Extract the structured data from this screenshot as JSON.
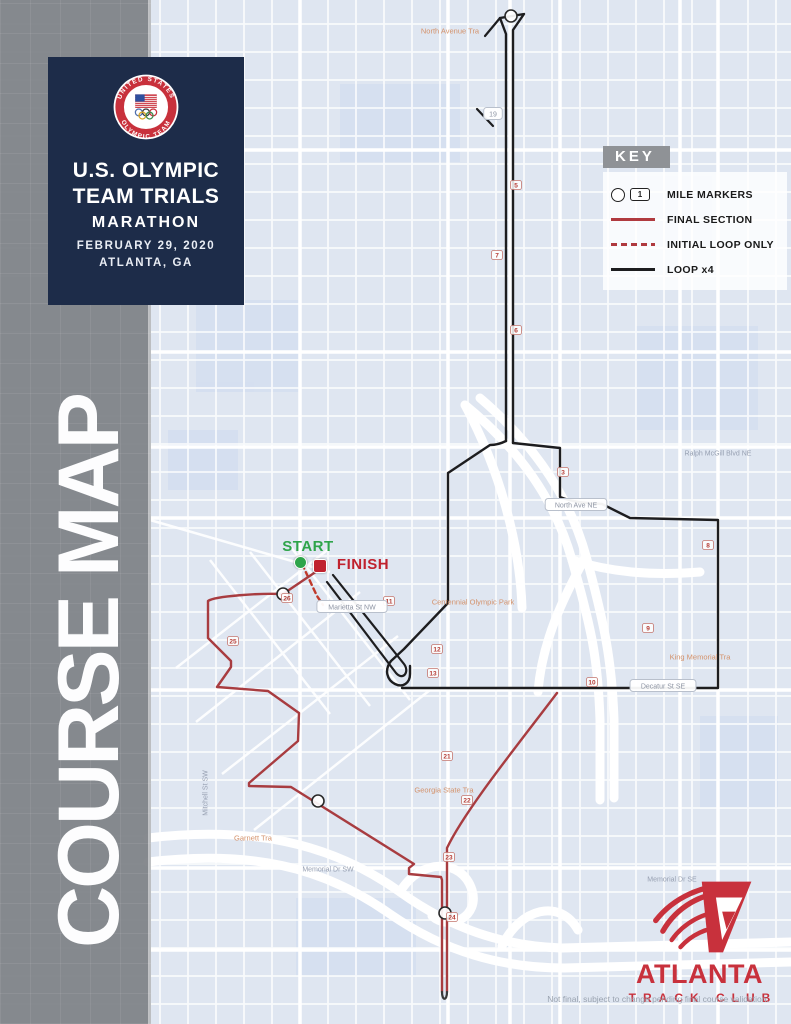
{
  "sidebar": {
    "vertical_text": "COURSE MAP"
  },
  "title_card": {
    "line1": "U.S. OLYMPIC",
    "line2": "TEAM TRIALS",
    "line3": "MARATHON",
    "line4": "FEBRUARY 29, 2020",
    "line5": "ATLANTA, GA",
    "logo_ring_top": "UNITED STATES",
    "logo_ring_bottom": "OLYMPIC TEAM"
  },
  "key": {
    "title": "KEY",
    "mile_marker_sample_number": "1",
    "items": [
      {
        "label": "MILE MARKERS"
      },
      {
        "label": "FINAL SECTION"
      },
      {
        "label": "INITIAL LOOP ONLY"
      },
      {
        "label": "LOOP x4"
      }
    ]
  },
  "start_finish": {
    "start": "START",
    "finish": "FINISH"
  },
  "atc_logo": {
    "name": "ATLANTA",
    "sub": "TRACK CLUB"
  },
  "footer": {
    "disclaimer": "Not final, subject to change pending final course validation."
  },
  "colors": {
    "navy": "#1d2c49",
    "sidebar_gray": "#8b8e93",
    "accent_red": "#c8313c",
    "route_red": "#a83c40",
    "route_black": "#1d1d1f",
    "start_green": "#2ea44a"
  },
  "map": {
    "routes": [
      {
        "name": "loop-north-outback",
        "color": "#1d1d1f",
        "width": 2.4,
        "d": "M 506,441 L 506,34 L 500,18 L 524,14 L 513,30 L 513,443"
      },
      {
        "name": "loop-north-hook-a",
        "color": "#1d1d1f",
        "width": 2.2,
        "d": "M 500,18 L 485,36"
      },
      {
        "name": "loop-north-hook-b",
        "color": "#1d1d1f",
        "width": 2.2,
        "d": "M 477,109 L 493,126"
      },
      {
        "name": "loop-west-side",
        "color": "#1d1d1f",
        "width": 2.4,
        "d": "M 506,441 C 500,444 495,445 490,445 L 448,473 L 448,603 L 404,649 L 391,661 C 384,670 387,680 395,684 C 403,688 410,683 410,674 L 410,666"
      },
      {
        "name": "loop-east-side",
        "color": "#1d1d1f",
        "width": 2.4,
        "d": "M 513,443 L 560,448 L 560,497 C 572,502 585,503 602,504 L 630,518 L 718,520 L 718,688 L 402,688"
      },
      {
        "name": "loop-downtown-spur",
        "color": "#1d1d1f",
        "width": 2.2,
        "d": "M 333,575 L 404,664 C 410,672 403,681 396,673 L 327,582"
      },
      {
        "name": "initial-loop-only",
        "color": "#c0392b",
        "width": 2.4,
        "dash": "5,4",
        "d": "M 302,564 L 317,596 L 323,605"
      },
      {
        "name": "final-section-west",
        "color": "#a83c40",
        "width": 2.4,
        "d": "M 320,569 L 283,594 C 260,593 215,596 208,601 L 208,638 L 231,661 L 231,667 L 217,687 L 268,691 L 299,713 L 298,741 L 249,783 L 249,786 L 291,787 L 414,864 L 409,868 L 409,874 L 441,877 L 442,880 L 442,992"
      },
      {
        "name": "final-section-east",
        "color": "#a83c40",
        "width": 2.4,
        "d": "M 447,992 L 447,848 C 465,810 520,742 557,693"
      },
      {
        "name": "final-turnaround",
        "color": "#3a3a3a",
        "width": 2.2,
        "d": "M 442,992 C 442,1001 447,1001 447,992"
      }
    ],
    "circles": [
      {
        "x": 283,
        "y": 594
      },
      {
        "x": 318,
        "y": 801
      },
      {
        "x": 445,
        "y": 913
      },
      {
        "x": 511,
        "y": 16
      }
    ],
    "mile_squares": [
      {
        "x": 516,
        "y": 185,
        "n": "5"
      },
      {
        "x": 516,
        "y": 330,
        "n": "6"
      },
      {
        "x": 497,
        "y": 255,
        "n": "7"
      },
      {
        "x": 563,
        "y": 472,
        "n": "3"
      },
      {
        "x": 708,
        "y": 545,
        "n": "8"
      },
      {
        "x": 648,
        "y": 628,
        "n": "9"
      },
      {
        "x": 592,
        "y": 682,
        "n": "10"
      },
      {
        "x": 389,
        "y": 601,
        "n": "11"
      },
      {
        "x": 437,
        "y": 649,
        "n": "12"
      },
      {
        "x": 433,
        "y": 673,
        "n": "13"
      },
      {
        "x": 447,
        "y": 756,
        "n": "21"
      },
      {
        "x": 467,
        "y": 800,
        "n": "22"
      },
      {
        "x": 449,
        "y": 857,
        "n": "23"
      },
      {
        "x": 452,
        "y": 917,
        "n": "24"
      },
      {
        "x": 233,
        "y": 641,
        "n": "25"
      },
      {
        "x": 287,
        "y": 598,
        "n": "26"
      }
    ],
    "labels": [
      {
        "x": 493,
        "y": 114,
        "text": "19",
        "style": "pill"
      },
      {
        "x": 576,
        "y": 505,
        "text": "North Ave NE",
        "style": "pill"
      },
      {
        "x": 352,
        "y": 607,
        "text": "Marietta St NW",
        "style": "pill"
      },
      {
        "x": 663,
        "y": 686,
        "text": "Decatur St SE",
        "style": "pill"
      },
      {
        "x": 718,
        "y": 453,
        "text": "Ralph McGill Blvd NE",
        "style": "plain"
      },
      {
        "x": 328,
        "y": 869,
        "text": "Memorial Dr SW",
        "style": "plain"
      },
      {
        "x": 672,
        "y": 879,
        "text": "Memorial Dr SE",
        "style": "plain"
      },
      {
        "x": 205,
        "y": 793,
        "text": "Mitchell St SW",
        "style": "plain",
        "rot": -90
      },
      {
        "x": 450,
        "y": 31,
        "text": "North Avenue Tra",
        "style": "poi"
      },
      {
        "x": 473,
        "y": 602,
        "text": "Centennial Olympic Park",
        "style": "poi"
      },
      {
        "x": 444,
        "y": 790,
        "text": "Georgia State Tra",
        "style": "poi"
      },
      {
        "x": 253,
        "y": 838,
        "text": "Garnett Tra",
        "style": "poi"
      },
      {
        "x": 700,
        "y": 657,
        "text": "King Memorial Tra",
        "style": "poi"
      }
    ]
  }
}
